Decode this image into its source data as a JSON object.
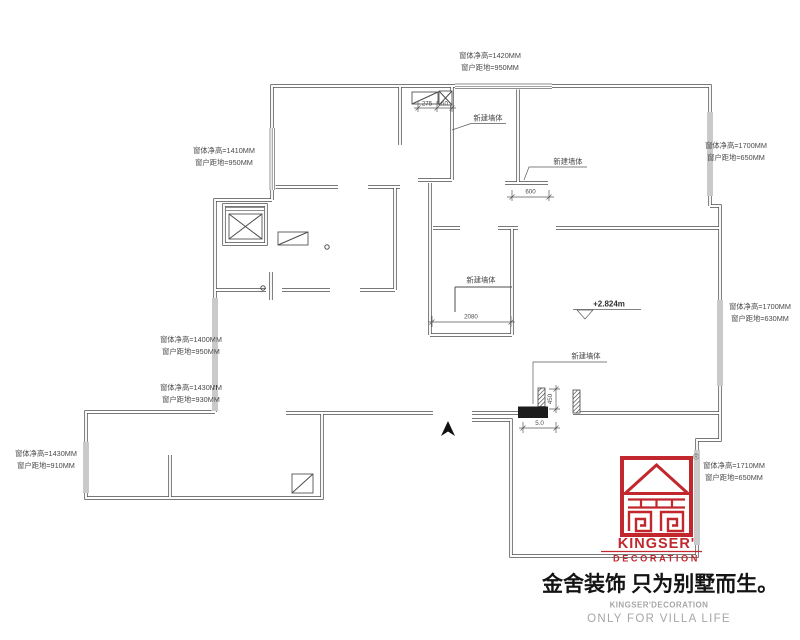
{
  "colors": {
    "accent_red": "#c1272d",
    "line_gray": "#4d4d4d",
    "muted_text_gray": "#a6a6a6"
  },
  "window_labels": [
    {
      "line1": "窗体净高=1420MM",
      "line2": "窗户距地=950MM"
    },
    {
      "line1": "窗体净高=1410MM",
      "line2": "窗户距地=950MM"
    },
    {
      "line1": "窗体净高=1700MM",
      "line2": "窗户距地=650MM"
    },
    {
      "line1": "窗体净高=1700MM",
      "line2": "窗户距地=630MM"
    },
    {
      "line1": "窗体净高=1400MM",
      "line2": "窗户距地=950MM"
    },
    {
      "line1": "窗体净高=1430MM",
      "line2": "窗户距地=930MM"
    },
    {
      "line1": "窗体净高=1430MM",
      "line2": "窗户距地=910MM"
    },
    {
      "line1": "窗体净高=1710MM",
      "line2": "窗户距地=650MM"
    }
  ],
  "plan_labels": {
    "new_wall": "新建墙体",
    "level": "+2.824m",
    "registered": "®"
  },
  "dimensions": {
    "d275": "275",
    "d60": "60",
    "d600": "600",
    "d2080": "2080",
    "d450": "450",
    "d50": "5.0"
  },
  "logo": {
    "title": "KINGSER'",
    "subtitle": "DECORATION"
  },
  "footer": {
    "slogan": "金舍装饰 只为别墅而生。",
    "brand_en": "KINGSER'DECORATION",
    "tagline": "ONLY FOR VILLA LIFE"
  }
}
